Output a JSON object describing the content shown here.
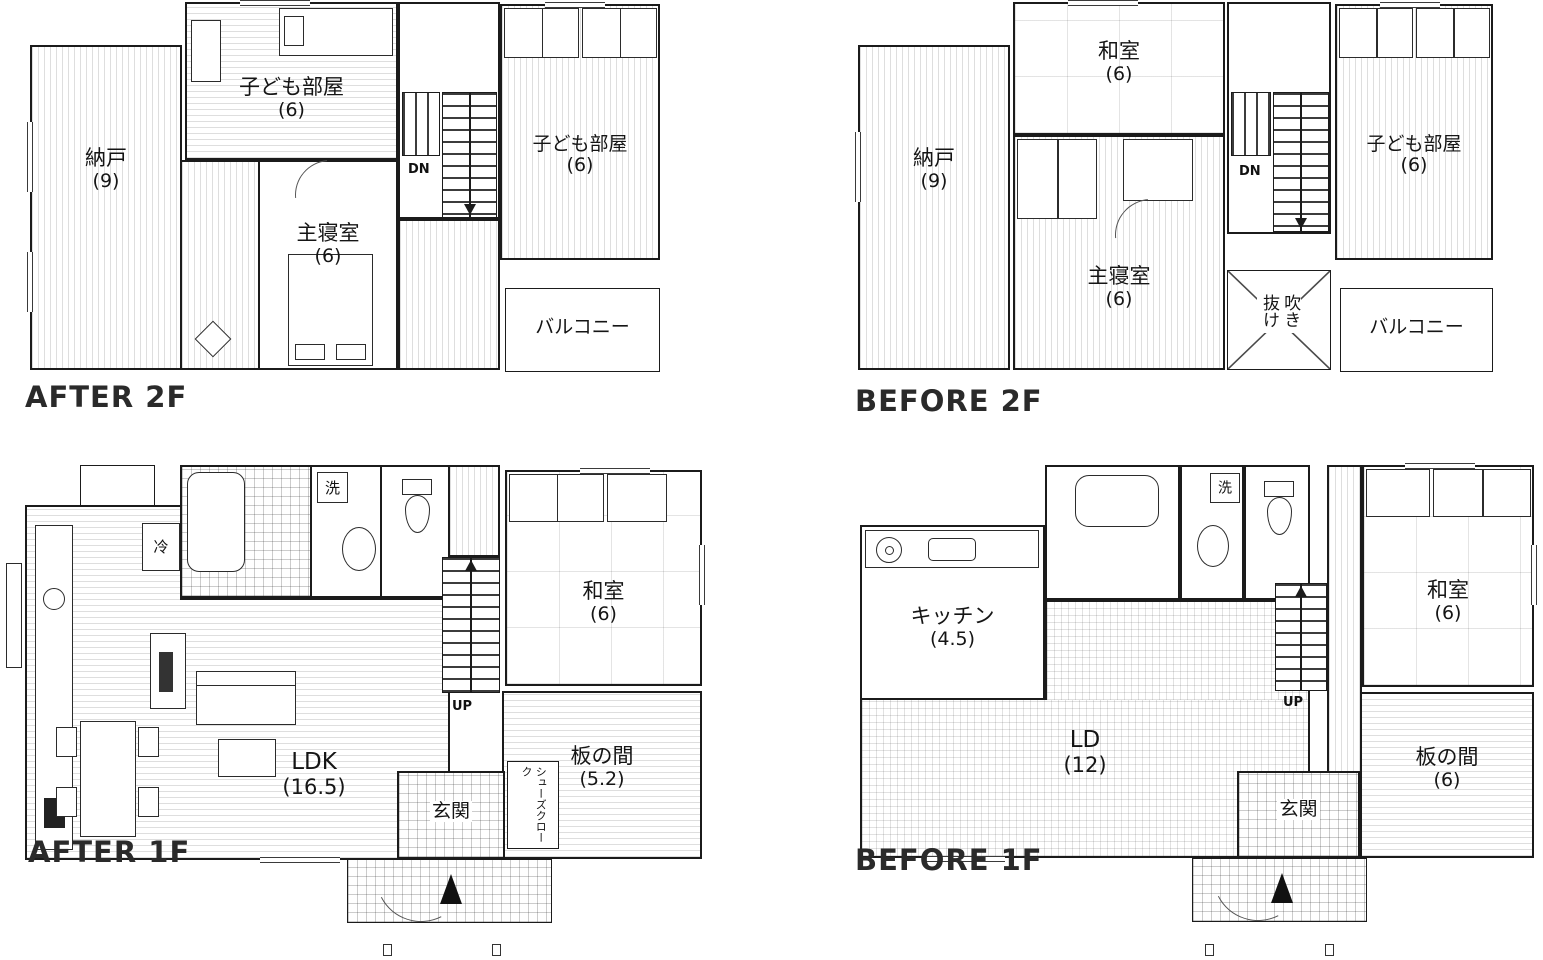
{
  "page": {
    "background": "#ffffff",
    "wall_color": "#1b1b1b"
  },
  "plans": {
    "after2f": {
      "caption": "AFTER 2F",
      "stairs_label": "DN",
      "rooms": {
        "nando": {
          "name": "納戸",
          "size": "(9)"
        },
        "kodomo_top": {
          "name": "子ども部屋",
          "size": "(6)"
        },
        "shinshitsu": {
          "name": "主寝室",
          "size": "(6)"
        },
        "kodomo_right": {
          "name": "子ども部屋",
          "size": "(6)"
        },
        "balcony": {
          "name": "バルコニー"
        }
      }
    },
    "before2f": {
      "caption": "BEFORE 2F",
      "stairs_label": "DN",
      "rooms": {
        "nando": {
          "name": "納戸",
          "size": "(9)"
        },
        "washitsu": {
          "name": "和室",
          "size": "(6)"
        },
        "shinshitsu": {
          "name": "主寝室",
          "size": "(6)"
        },
        "kodomo": {
          "name": "子ども部屋",
          "size": "(6)"
        },
        "fukinuke": {
          "name": "吹き抜け"
        },
        "balcony": {
          "name": "バルコニー"
        }
      }
    },
    "after1f": {
      "caption": "AFTER 1F",
      "stairs_label": "UP",
      "rooms": {
        "ldk": {
          "name": "LDK",
          "size": "(16.5)"
        },
        "washitsu": {
          "name": "和室",
          "size": "(6)"
        },
        "itanoma": {
          "name": "板の間",
          "size": "(5.2)"
        },
        "genkan": {
          "name": "玄関"
        },
        "cloak": {
          "name": "シューズクローク"
        },
        "fridge": {
          "name": "冷"
        },
        "laundry": {
          "name": "洗"
        }
      }
    },
    "before1f": {
      "caption": "BEFORE 1F",
      "stairs_label": "UP",
      "rooms": {
        "kitchen": {
          "name": "キッチン",
          "size": "(4.5)"
        },
        "ld": {
          "name": "LD",
          "size": "(12)"
        },
        "washitsu": {
          "name": "和室",
          "size": "(6)"
        },
        "itanoma": {
          "name": "板の間",
          "size": "(6)"
        },
        "genkan": {
          "name": "玄関"
        },
        "laundry": {
          "name": "洗"
        }
      }
    }
  }
}
